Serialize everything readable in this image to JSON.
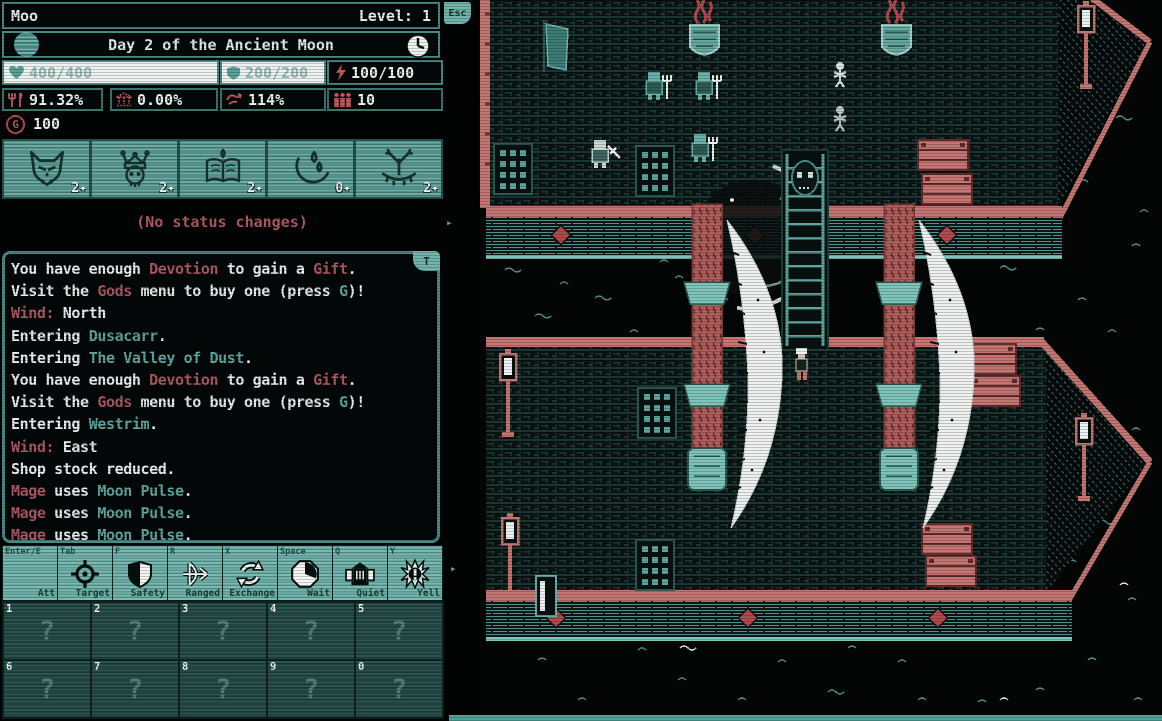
{
  "header": {
    "player_name": "Moo",
    "level_label": "Level: 1",
    "esc_label": "Esc"
  },
  "day": {
    "text": "Day 2 of the Ancient Moon"
  },
  "vitals": [
    {
      "id": "health",
      "icon": "heart-icon",
      "value": "400/400"
    },
    {
      "id": "armor",
      "icon": "shield-icon",
      "value": "200/200"
    },
    {
      "id": "energy",
      "icon": "lightning-icon",
      "value": "100/100"
    }
  ],
  "stats": [
    {
      "id": "food",
      "icon": "utensils-icon",
      "value": "91.32%"
    },
    {
      "id": "burden",
      "icon": "temple-icon",
      "value": "0.00%"
    },
    {
      "id": "wind",
      "icon": "wind-icon",
      "value": "114%"
    },
    {
      "id": "crew",
      "icon": "crew-icon",
      "value": "10"
    }
  ],
  "gold": {
    "symbol": "G",
    "amount": "100"
  },
  "sigils": [
    {
      "icon": "wolf-icon",
      "count": "2✦"
    },
    {
      "icon": "crowned-skull-icon",
      "count": "2✦"
    },
    {
      "icon": "tome-icon",
      "count": "2✦"
    },
    {
      "icon": "moon-drops-icon",
      "count": "0✦"
    },
    {
      "icon": "antler-icon",
      "count": "2✦"
    }
  ],
  "status_line": "(No status changes)",
  "log": {
    "tab_label": "T",
    "lines": [
      [
        {
          "t": "You have enough ",
          "c": "w"
        },
        {
          "t": "Devotion",
          "c": "r"
        },
        {
          "t": " to gain a ",
          "c": "w"
        },
        {
          "t": "Gift",
          "c": "r"
        },
        {
          "t": ".",
          "c": "w"
        }
      ],
      [
        {
          "t": "Visit the ",
          "c": "w"
        },
        {
          "t": "Gods",
          "c": "r"
        },
        {
          "t": " menu to buy one (press ",
          "c": "w"
        },
        {
          "t": "G",
          "c": "t"
        },
        {
          "t": ")!",
          "c": "w"
        }
      ],
      [
        {
          "t": "Wind:",
          "c": "r"
        },
        {
          "t": " North",
          "c": "w"
        }
      ],
      [
        {
          "t": "Entering ",
          "c": "w"
        },
        {
          "t": "Dusacarr",
          "c": "t"
        },
        {
          "t": ".",
          "c": "w"
        }
      ],
      [
        {
          "t": "Entering ",
          "c": "w"
        },
        {
          "t": "The Valley of Dust",
          "c": "t"
        },
        {
          "t": ".",
          "c": "w"
        }
      ],
      [
        {
          "t": "You have enough ",
          "c": "w"
        },
        {
          "t": "Devotion",
          "c": "r"
        },
        {
          "t": " to gain a ",
          "c": "w"
        },
        {
          "t": "Gift",
          "c": "r"
        },
        {
          "t": ".",
          "c": "w"
        }
      ],
      [
        {
          "t": "Visit the ",
          "c": "w"
        },
        {
          "t": "Gods",
          "c": "r"
        },
        {
          "t": " menu to buy one (press ",
          "c": "w"
        },
        {
          "t": "G",
          "c": "t"
        },
        {
          "t": ")!",
          "c": "w"
        }
      ],
      [
        {
          "t": "Entering ",
          "c": "w"
        },
        {
          "t": "Westrim",
          "c": "t"
        },
        {
          "t": ".",
          "c": "w"
        }
      ],
      [
        {
          "t": "Wind:",
          "c": "r"
        },
        {
          "t": " East",
          "c": "w"
        }
      ],
      [
        {
          "t": "Shop stock reduced.",
          "c": "w"
        }
      ],
      [
        {
          "t": "Mage",
          "c": "r"
        },
        {
          "t": " uses ",
          "c": "w"
        },
        {
          "t": "Moon Pulse",
          "c": "t"
        },
        {
          "t": ".",
          "c": "w"
        }
      ],
      [
        {
          "t": "Mage",
          "c": "r"
        },
        {
          "t": " uses ",
          "c": "w"
        },
        {
          "t": "Moon Pulse",
          "c": "t"
        },
        {
          "t": ".",
          "c": "w"
        }
      ],
      [
        {
          "t": "Mage",
          "c": "r"
        },
        {
          "t": " uses ",
          "c": "w"
        },
        {
          "t": "Moon Pulse",
          "c": "t"
        },
        {
          "t": ".",
          "c": "w"
        }
      ]
    ]
  },
  "hotbar": [
    {
      "key": "Enter/E",
      "action": "Att",
      "icon": "none"
    },
    {
      "key": "Tab",
      "action": "Target",
      "icon": "crosshair-icon"
    },
    {
      "key": "F",
      "action": "Safety",
      "icon": "shield-icon"
    },
    {
      "key": "R",
      "action": "Ranged",
      "icon": "bow-arrow-icon"
    },
    {
      "key": "X",
      "action": "Exchange",
      "icon": "cycle-arrows-icon"
    },
    {
      "key": "Space",
      "action": "Wait",
      "icon": "wait-clock-icon"
    },
    {
      "key": "Q",
      "action": "Quiet",
      "icon": "horn-building-icon"
    },
    {
      "key": "Y",
      "action": "Yell",
      "icon": "burst-icon"
    }
  ],
  "slots": {
    "row1": [
      {
        "num": "1",
        "glyph": "?"
      },
      {
        "num": "2",
        "glyph": "?"
      },
      {
        "num": "3",
        "glyph": "?"
      },
      {
        "num": "4",
        "glyph": "?"
      },
      {
        "num": "5",
        "glyph": "?"
      }
    ],
    "row2": [
      {
        "num": "6",
        "glyph": "?"
      },
      {
        "num": "7",
        "glyph": "?"
      },
      {
        "num": "8",
        "glyph": "?"
      },
      {
        "num": "9",
        "glyph": "?"
      },
      {
        "num": "0",
        "glyph": "?"
      }
    ]
  },
  "panel_arrow": "▸",
  "colors": {
    "teal": "#5fa8a0",
    "hotbar_teal": "#72b3ab",
    "salmon": "#c47672",
    "red": "#b14a4e",
    "pink_text": "#ad5964",
    "white": "#e9edec",
    "background": "#040707"
  },
  "scene": {
    "view": "top-down pixel-art ship boarding scene over dark water",
    "objects": [
      "large ship hull top",
      "large ship hull bottom",
      "boarding ladder",
      "two masts with white sails",
      "mast-top pennants",
      "crew with pitchforks",
      "guard with sword",
      "skeleton crew",
      "player character",
      "cargo crates",
      "deck grates",
      "ship lamps",
      "porthole diamonds",
      "water waves",
      "moon pulse swirl"
    ]
  }
}
